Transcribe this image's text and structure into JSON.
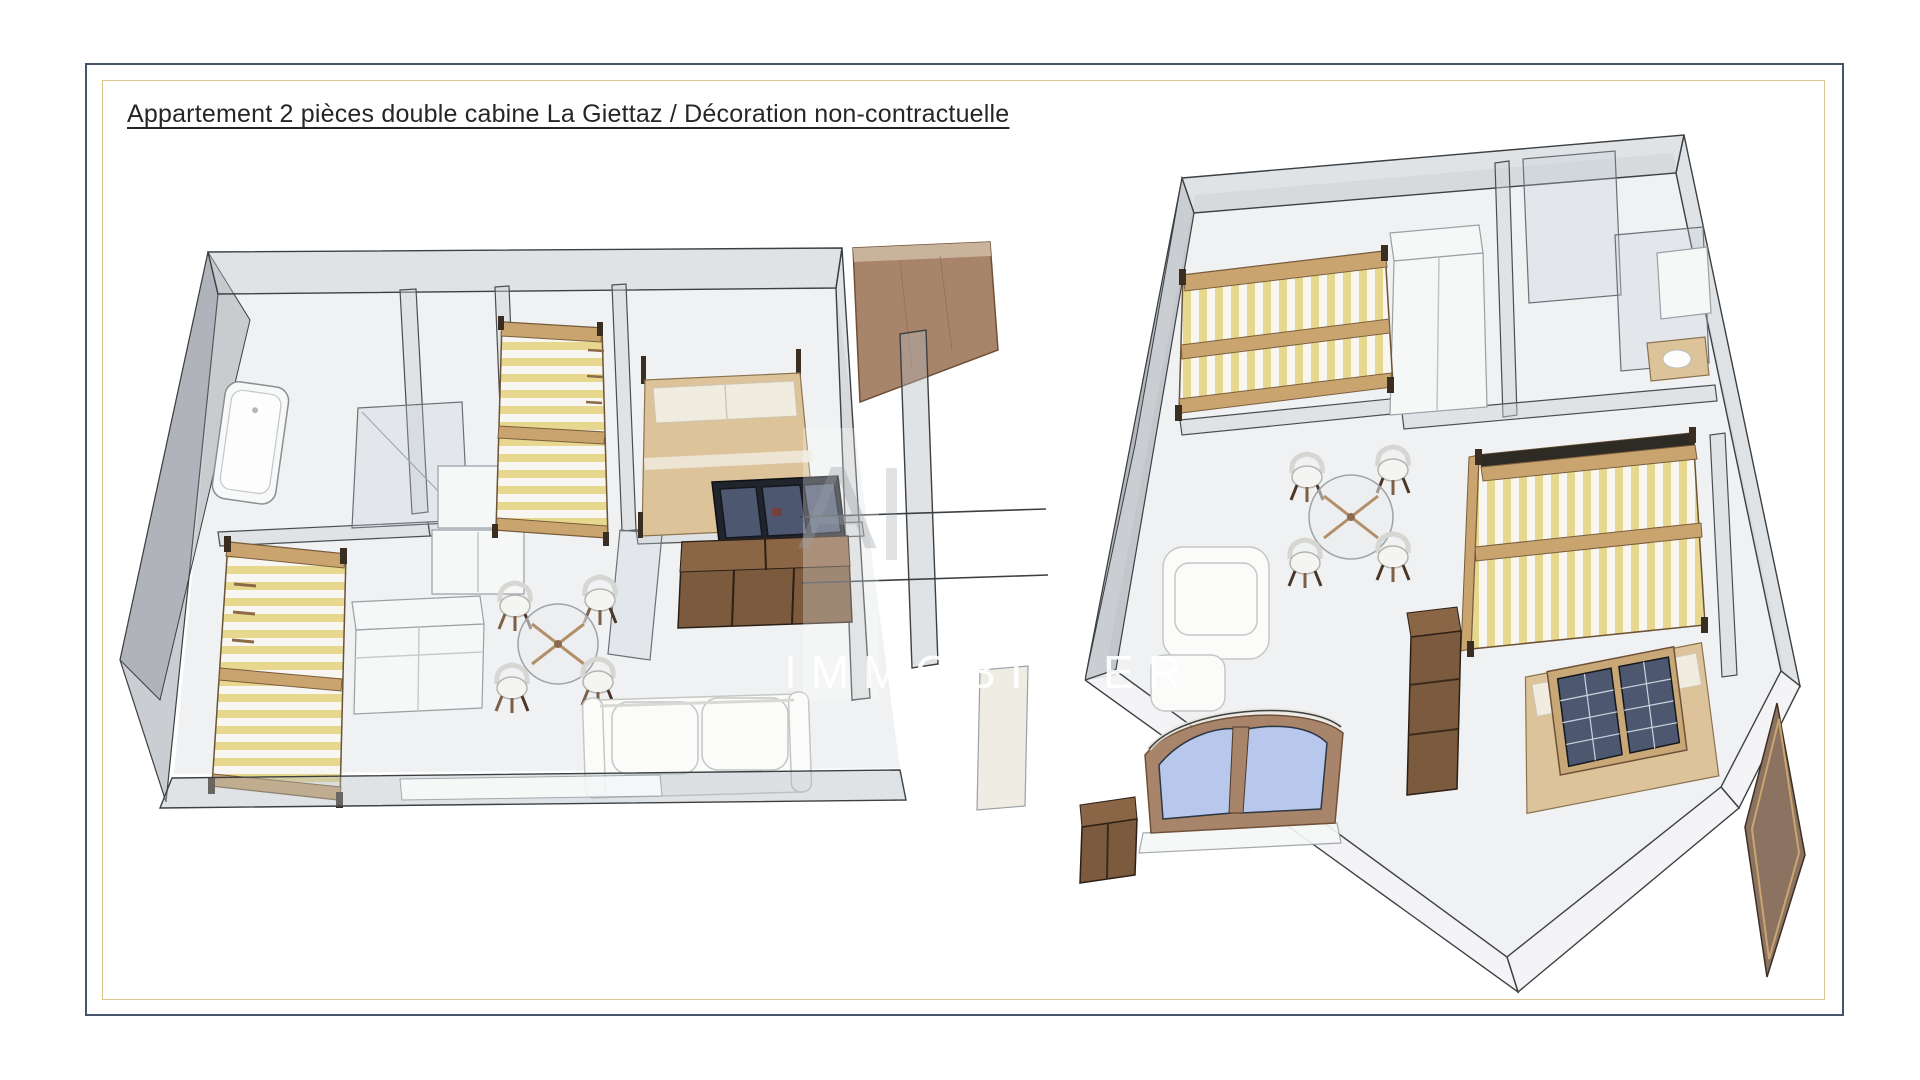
{
  "page": {
    "title": "Appartement 2 pièces double cabine La Giettaz / Décoration non-contractuelle"
  },
  "watermark": {
    "fragment": "A",
    "text": "IMMOBILIER"
  },
  "colors": {
    "frame_outer": "#44546A",
    "frame_inner": "#D9C386",
    "floor": "#EDEFF0",
    "wood_light": "#CAA46F",
    "wood_mid": "#A8846A",
    "wood_dark": "#6F4F36",
    "cabinet_brown": "#7B5A3E",
    "stripe_yellow": "#E8D88F",
    "mattress_white": "#F7F6F0",
    "bed_tan": "#DCC39A",
    "pillow": "#F1ECE0",
    "navy_cabinet": "#20242C",
    "glass_pane": "#4D5870",
    "window_blue": "#B7C8EC",
    "sofa_white": "#FBFBFA"
  },
  "floorplans": {
    "left": {
      "name": "floorplan-left",
      "items": [
        "bathtub",
        "shower",
        "closets",
        "bunk-bed-left",
        "bunk-bed-cabin",
        "double-bed",
        "tv-cabinet",
        "storage-cabinet",
        "kitchen-counter",
        "dining-set",
        "sofa",
        "wood-panel"
      ]
    },
    "right": {
      "name": "floorplan-right",
      "items": [
        "bunk-bed-top",
        "wardrobe",
        "bathroom",
        "washbasin",
        "dining-set",
        "bunk-bed-large",
        "bed-with-windows",
        "armchair",
        "kitchen-column",
        "arched-window",
        "entry-door",
        "cabinet"
      ]
    }
  }
}
